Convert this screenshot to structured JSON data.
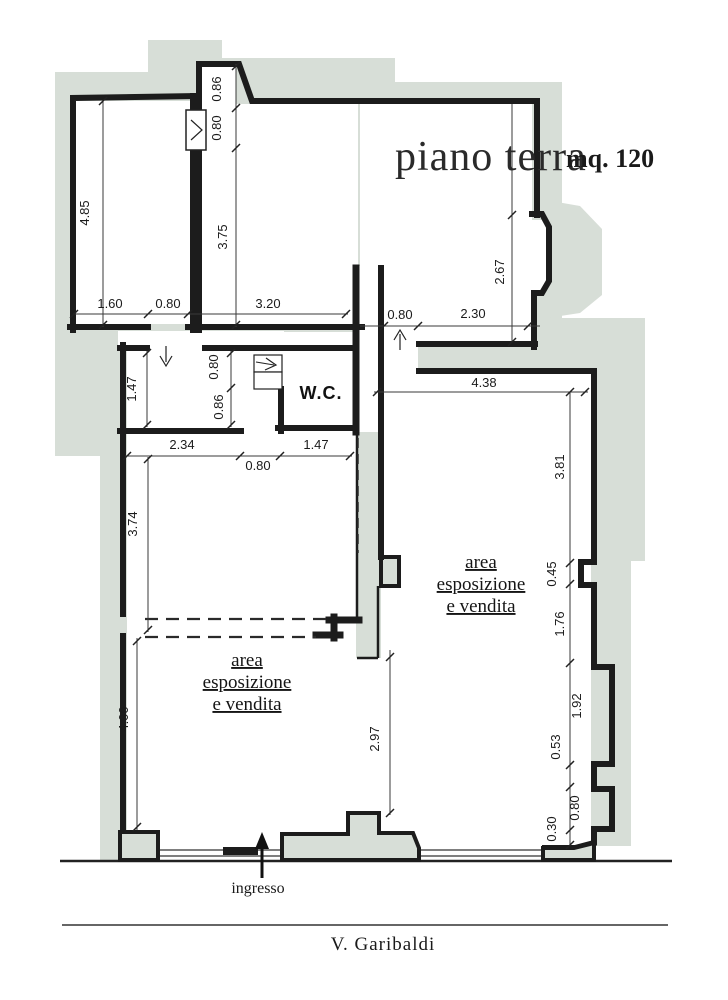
{
  "title": {
    "name": "piano terra",
    "area": "mq. 120"
  },
  "rooms": {
    "wc_label": "W.C.",
    "sales_right": [
      "area",
      "esposizione",
      "e vendita"
    ],
    "sales_left": [
      "area",
      "esposizione",
      "e vendita"
    ]
  },
  "labels": {
    "entrance": "ingresso",
    "street": "V. Garibaldi"
  },
  "dimensions": {
    "a_height": "4.85",
    "a_w1": "1.60",
    "a_door": "0.80",
    "b_width": "3.20",
    "b_nook": "0.86",
    "ab_door": "0.80",
    "b_height": "3.75",
    "c_bay": "2.67",
    "c_pass": "0.80",
    "c_width": "2.30",
    "e_top": "4.38",
    "hall_room": "1.47",
    "hall_v1": "0.80",
    "hall_v2": "0.86",
    "d_w1": "2.34",
    "d_w2": "1.47",
    "d_door": "0.80",
    "d_height": "3.74",
    "e_r1": "3.81",
    "e_r2": "0.45",
    "e_r3": "1.76",
    "e_r4": "1.92",
    "e_r5": "0.53",
    "e_r6": "0.80",
    "e_r7": "0.30",
    "f_height": "4.00",
    "ef_open": "2.97"
  },
  "colors": {
    "footprint": "#d7ded7",
    "wall": "#1c1c1c",
    "dim_line": "#3a3a3a"
  }
}
